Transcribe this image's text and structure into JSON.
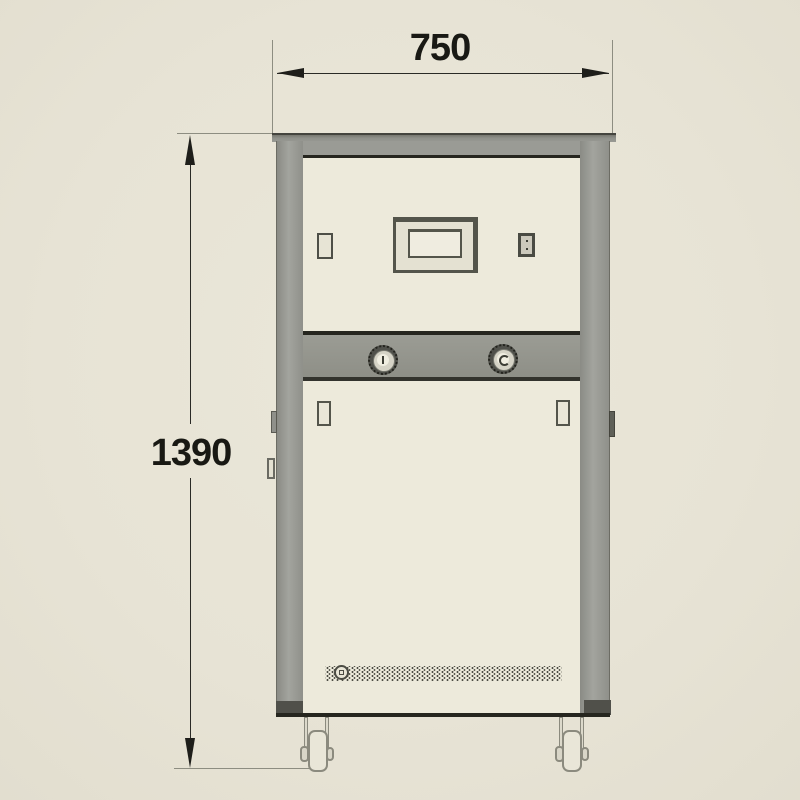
{
  "drawing": {
    "title": "machine-front-elevation",
    "width_dim_label": "750",
    "height_dim_label": "1390"
  },
  "machine": {
    "parts": {
      "display": "control-display",
      "switch": "power-rocker-switch",
      "slot": "side-vent-slot",
      "coupling_left": "water-coupling-left",
      "coupling_right": "water-coupling-right",
      "latch_left": "door-latch-left",
      "latch_right": "door-latch-right",
      "vent": "perforated-vent-strip",
      "caster_left": "swivel-caster-left",
      "caster_right": "swivel-caster-right"
    }
  },
  "colors": {
    "background": "#e7e3d5",
    "panel_cream": "#edeadb",
    "frame_gray": "#97988f",
    "band_gray": "#929389",
    "outline_dark": "#26261f",
    "dimension_line": "#2a2a26",
    "dimension_text": "#191914"
  }
}
